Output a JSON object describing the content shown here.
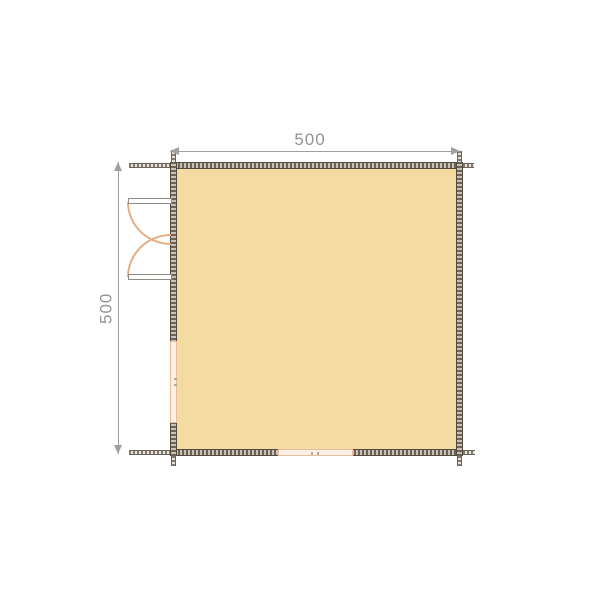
{
  "drawing": {
    "kind": "floor-plan",
    "room": {
      "name": "main-room",
      "width_label": "500",
      "depth_label": "500"
    },
    "openings": [
      {
        "name": "double-door-symbol",
        "wall": "left"
      },
      {
        "name": "window-symbol",
        "wall": "left"
      },
      {
        "name": "window-symbol",
        "wall": "bottom"
      }
    ]
  },
  "dimensions": {
    "top": {
      "label": "500"
    },
    "left": {
      "label": "500"
    }
  },
  "colors": {
    "background": "#ffffff",
    "floor_fill": "#f3dba2",
    "wall_dark": "#6b6258",
    "wall_light": "#c9c1b6",
    "wall_edge": "#52493f",
    "window_fill": "#fdf0e7",
    "window_frame": "#e9bd99",
    "door_leaf_outline": "#8f8a83",
    "door_swing_arc": "#e7ae83",
    "dimension_line": "#a0a0a0",
    "dimension_text": "#949494"
  }
}
